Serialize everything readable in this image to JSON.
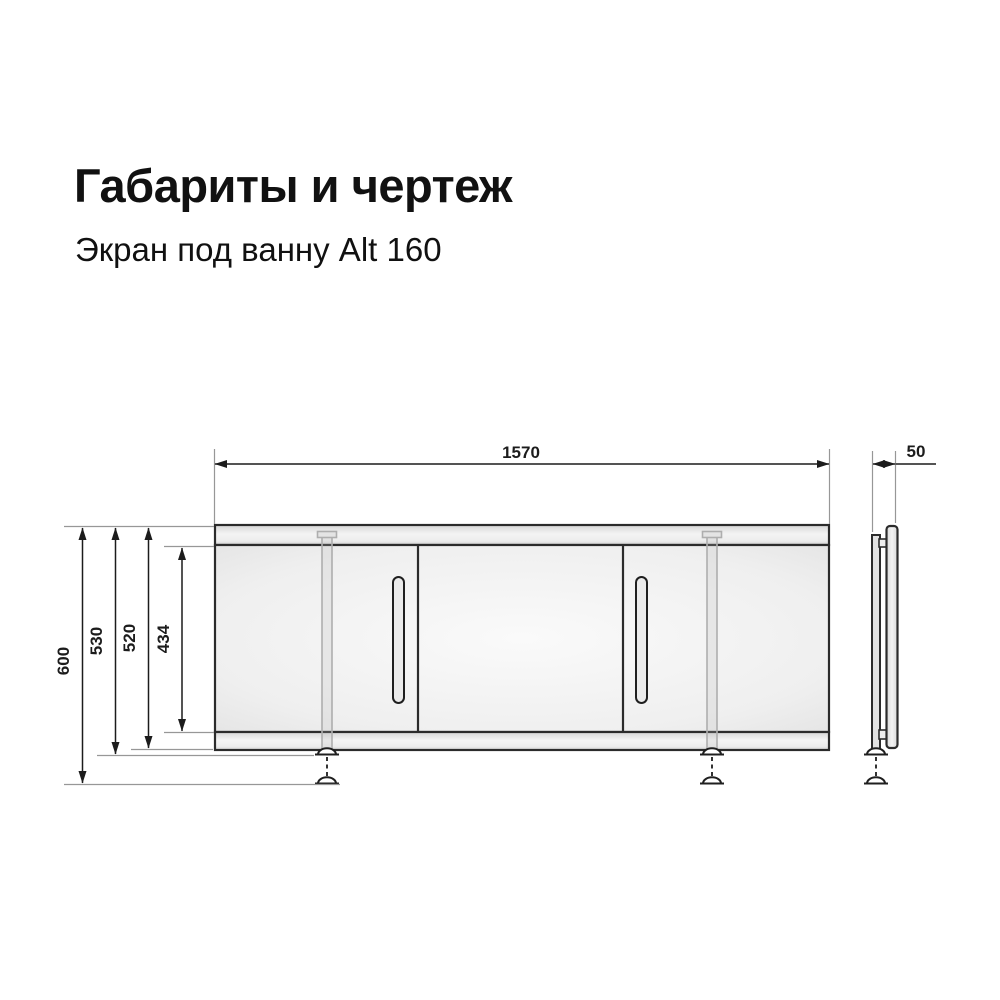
{
  "header": {
    "title": "Габариты и чертеж",
    "subtitle": "Экран под ванну Alt 160"
  },
  "drawing": {
    "views": {
      "front": "front elevation of bath screen with two sliding doors, two legs with adjustable feet",
      "side": "side profile of bath screen panel with leg and adjustable foot"
    },
    "dimensions": {
      "width": "1570",
      "height_overall": "600",
      "height_to_foot_base": "530",
      "height_frame": "520",
      "door_opening_height": "434",
      "depth": "50"
    }
  },
  "colors": {
    "background": "#ffffff",
    "ink": "#111111",
    "outline": "#2b2b2b",
    "extension_line": "#979797",
    "panel_fill_light": "#f7f7f7",
    "panel_fill_dark": "#e2e2e2"
  }
}
